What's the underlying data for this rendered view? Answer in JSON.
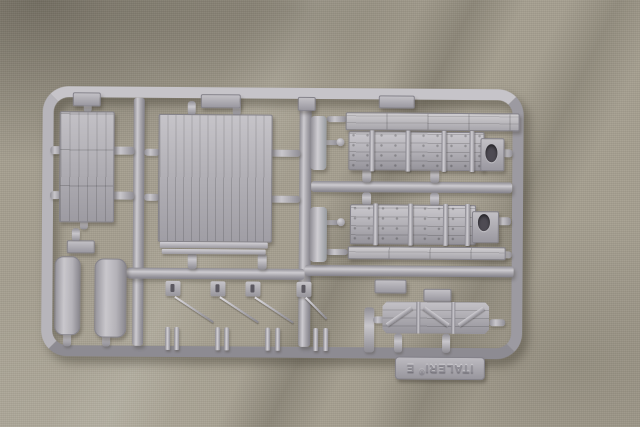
{
  "scene": {
    "description": "Photograph of a grey injection-moulded model kit sprue lying on khaki fabric",
    "background": "khaki cloth with diagonal wrinkle shadows"
  },
  "sprue": {
    "brand": "ITALERI",
    "registered_mark": "®",
    "sprue_letter": "E",
    "tab_note": "embossed brand tab moulded upside-down on the bottom rail"
  },
  "parts": [
    {
      "name": "planked-deck-panel",
      "desc": "narrow vertical planked deck panel",
      "count": 1
    },
    {
      "name": "large-planked-panel",
      "desc": "large rectangular planked roof/floor panel",
      "count": 1
    },
    {
      "name": "tarpaulin-bale",
      "desc": "rounded elongated cover part",
      "count": 2
    },
    {
      "name": "wagon-side-thin-plank",
      "desc": "long thin planked strip",
      "count": 2
    },
    {
      "name": "wagon-side-with-stanchions",
      "desc": "long wagon side with stanchions and oval handhold",
      "count": 2
    },
    {
      "name": "wagon-end-braced",
      "desc": "short braced wagon end panel",
      "count": 1
    },
    {
      "name": "buffer-beam",
      "desc": "small elongated beam on centre runner",
      "count": 2
    },
    {
      "name": "small-moulding-tab",
      "desc": "small rectangular tab part",
      "count": 6
    },
    {
      "name": "brake-clip-with-wire",
      "desc": "small clip with thin moulded wire",
      "count": 4
    },
    {
      "name": "handrail-post-pair",
      "desc": "pair of thin posts on bottom rail",
      "count": 4
    }
  ],
  "colors": {
    "fabric_base": "#a59f90",
    "fabric_highlight": "#bdb8a9",
    "fabric_shadow": "#7e7869",
    "plastic_base": "#adabb1",
    "plastic_light": "#d6d4d8",
    "plastic_mid": "#96949b",
    "plastic_dark": "#6f6d75",
    "hole_dark": "#4e4b53",
    "cast_shadow": "rgba(55,50,40,0.45)"
  }
}
